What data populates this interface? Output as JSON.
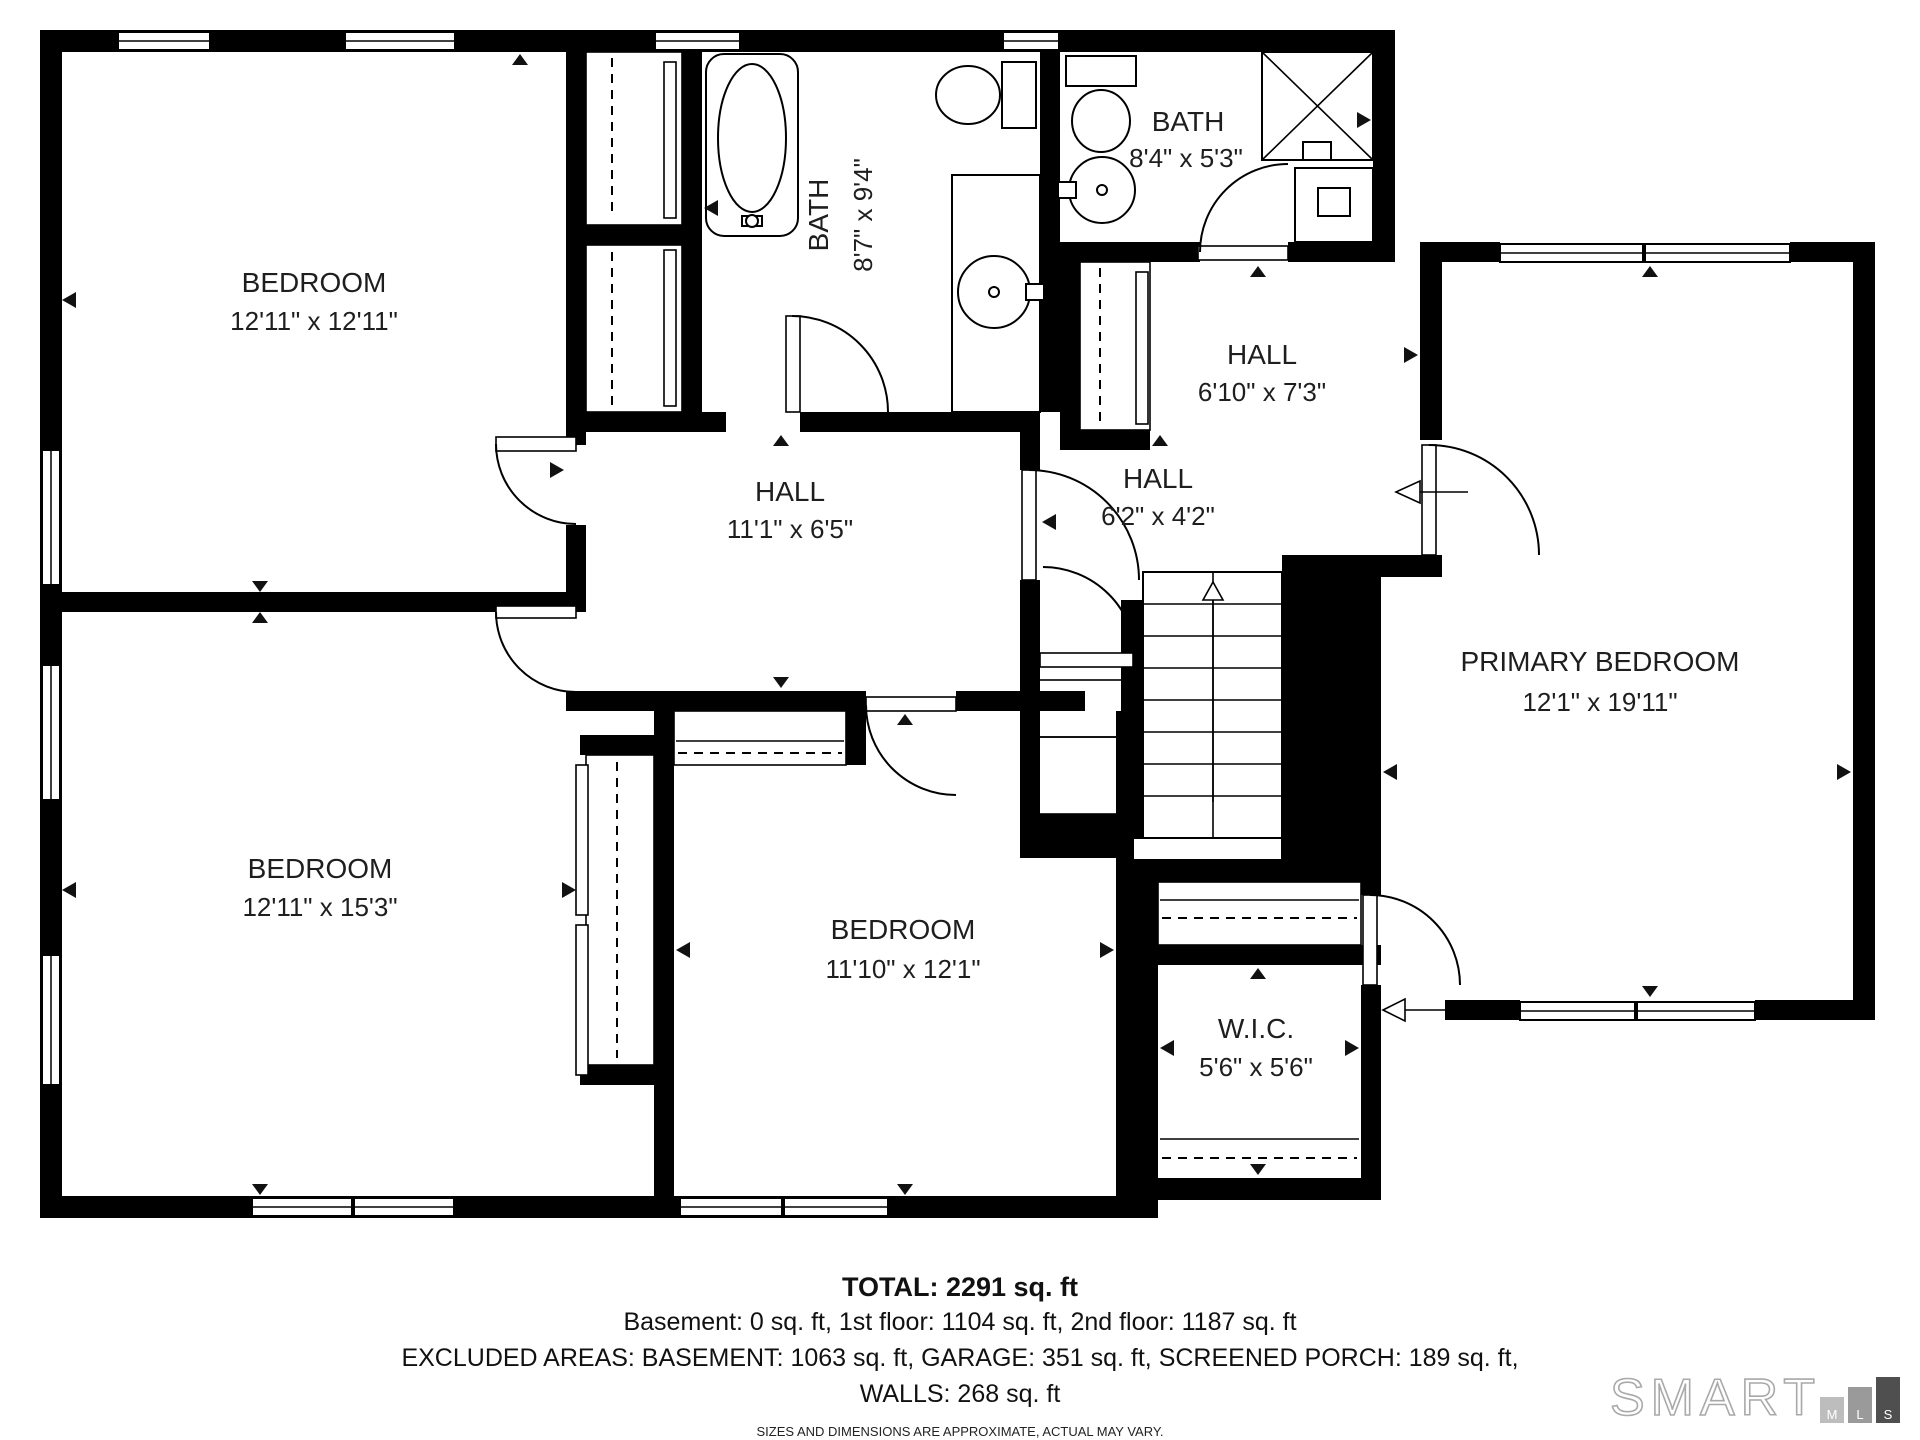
{
  "rooms": [
    {
      "id": "bedroom-top-left",
      "name": "BEDROOM",
      "dims": "12'11\" x 12'11\""
    },
    {
      "id": "bath-main",
      "name": "BATH",
      "dims": "8'7\" x 9'4\""
    },
    {
      "id": "bath-second",
      "name": "BATH",
      "dims": "8'4\" x 5'3\""
    },
    {
      "id": "hall-upper",
      "name": "HALL",
      "dims": "6'10\" x 7'3\""
    },
    {
      "id": "hall-center",
      "name": "HALL",
      "dims": "11'1\" x 6'5\""
    },
    {
      "id": "hall-small",
      "name": "HALL",
      "dims": "6'2\" x 4'2\""
    },
    {
      "id": "primary-bedroom",
      "name": "PRIMARY BEDROOM",
      "dims": "12'1\" x 19'11\""
    },
    {
      "id": "bedroom-bottom-left",
      "name": "BEDROOM",
      "dims": "12'11\" x 15'3\""
    },
    {
      "id": "bedroom-bottom-center",
      "name": "BEDROOM",
      "dims": "11'10\" x 12'1\""
    },
    {
      "id": "walk-in-closet",
      "name": "W.I.C.",
      "dims": "5'6\" x 5'6\""
    }
  ],
  "summary": {
    "total": "TOTAL: 2291 sq. ft",
    "floors": "Basement: 0 sq. ft, 1st floor: 1104 sq. ft, 2nd floor: 1187 sq. ft",
    "excluded": "EXCLUDED AREAS: BASEMENT: 1063 sq. ft, GARAGE: 351 sq. ft, SCREENED PORCH: 189 sq. ft,",
    "walls": "WALLS: 268 sq. ft",
    "disclaimer": "SIZES AND DIMENSIONS ARE APPROXIMATE, ACTUAL MAY VARY."
  },
  "logo": {
    "brand": "SMART",
    "letters": [
      "M",
      "L",
      "S"
    ]
  },
  "colors": {
    "wall": "#000000",
    "text": "#1e1e1e",
    "logo_outline": "#a9a9a9",
    "bar_m": "#bdbdbd",
    "bar_l": "#9a9a9a",
    "bar_s": "#4f4f4f"
  }
}
